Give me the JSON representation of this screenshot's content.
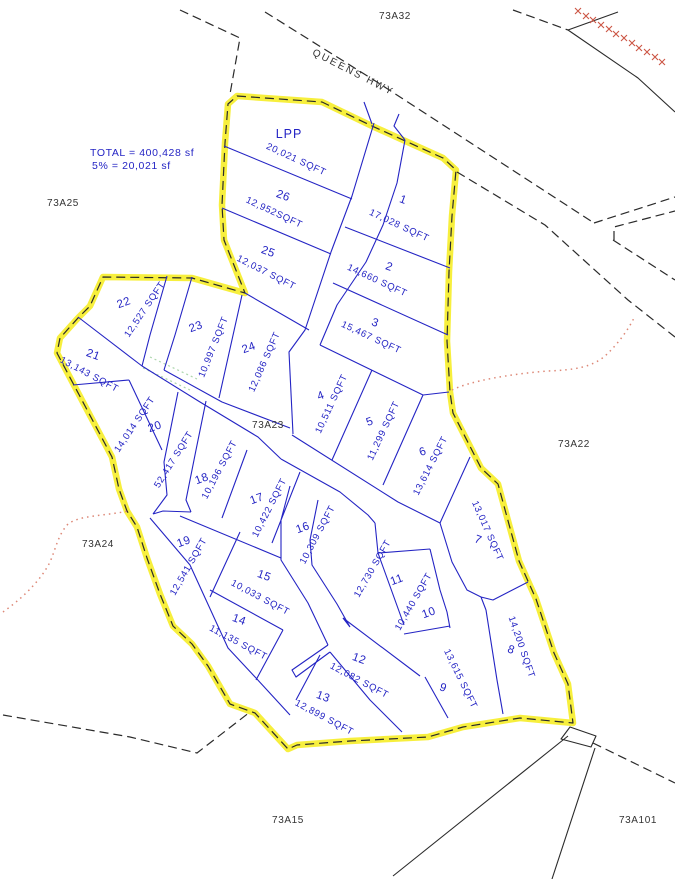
{
  "map": {
    "road_name": "QUEENS HWY",
    "summary": {
      "total_line": "TOTAL = 400,428 sf",
      "pct_line": "5% = 20,021 sf"
    },
    "road_area_label": "52,417 SQFT",
    "sheet_labels": {
      "n": "73A32",
      "nw": "73A25",
      "w": "73A24",
      "center": "73A23",
      "e": "73A22",
      "s": "73A15",
      "se": "73A101"
    },
    "lots": [
      {
        "id": "LPP",
        "area": "20,021 SQFT"
      },
      {
        "id": "1",
        "area": "17,028 SQFT"
      },
      {
        "id": "2",
        "area": "14,660 SQFT"
      },
      {
        "id": "3",
        "area": "15,467 SQFT"
      },
      {
        "id": "4",
        "area": "10,511 SQFT"
      },
      {
        "id": "5",
        "area": "11,299 SQFT"
      },
      {
        "id": "6",
        "area": "13,614 SQFT"
      },
      {
        "id": "7",
        "area": "13,017 SQFT"
      },
      {
        "id": "8",
        "area": "14,200 SQFT"
      },
      {
        "id": "9",
        "area": "13,615 SQFT"
      },
      {
        "id": "10",
        "area": "10,440 SQFT"
      },
      {
        "id": "11",
        "area": "12,730 SQFT"
      },
      {
        "id": "12",
        "area": "12,082 SQFT"
      },
      {
        "id": "13",
        "area": "12,899 SQFT"
      },
      {
        "id": "14",
        "area": "11,135 SQFT"
      },
      {
        "id": "15",
        "area": "10,033 SQFT"
      },
      {
        "id": "16",
        "area": "10,309 SQFT"
      },
      {
        "id": "17",
        "area": "10,422 SQFT"
      },
      {
        "id": "18",
        "area": "10,196 SQFT"
      },
      {
        "id": "19",
        "area": "12,541 SQFT"
      },
      {
        "id": "20",
        "area": "14,014 SQFT"
      },
      {
        "id": "21",
        "area": "13,143 SQFT"
      },
      {
        "id": "22",
        "area": "12,527 SQFT"
      },
      {
        "id": "23",
        "area": "10,997 SQFT"
      },
      {
        "id": "24",
        "area": "12,086 SQFT"
      },
      {
        "id": "25",
        "area": "12,037 SQFT"
      },
      {
        "id": "26",
        "area": "12,952SQFT"
      }
    ]
  },
  "colors": {
    "parcel_blue": "#2424c4",
    "boundary_yellow": "#f6ee2d",
    "dashed_black": "#2a2a2a",
    "red_dotted": "#dd8877",
    "cross_red": "#cc5544",
    "green_dotted": "#99cc99"
  }
}
